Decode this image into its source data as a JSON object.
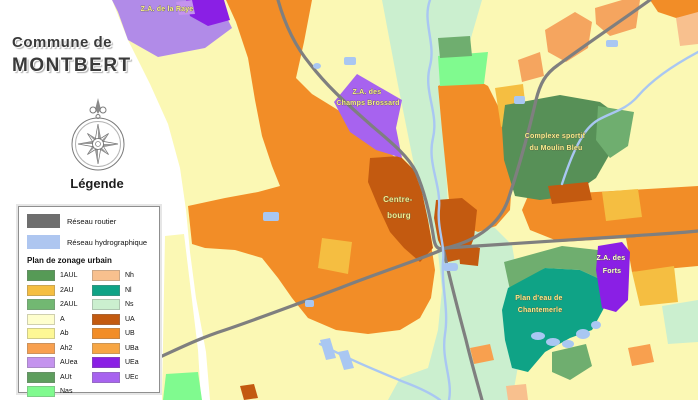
{
  "title": {
    "line1": "Commune de",
    "line2": "MONTBERT"
  },
  "legend": {
    "heading": "Légende",
    "network_items": [
      {
        "label": "Réseau routier",
        "color": "#6E6E6E"
      },
      {
        "label": "Réseau hydrographique",
        "color": "#AEC6F0"
      }
    ],
    "zonage_title": "Plan de zonage urbain",
    "zonage_left": [
      {
        "code": "1AUL",
        "color": "#569A56"
      },
      {
        "code": "2AU",
        "color": "#F5BE41"
      },
      {
        "code": "2AUL",
        "color": "#72B872"
      },
      {
        "code": "A",
        "color": "#FEFECD"
      },
      {
        "code": "Ab",
        "color": "#FDF795"
      },
      {
        "code": "Ah2",
        "color": "#F8A04F"
      },
      {
        "code": "AUea",
        "color": "#C493EE"
      },
      {
        "code": "AUt",
        "color": "#5E9E5E"
      },
      {
        "code": "Nas",
        "color": "#80FA8F"
      }
    ],
    "zonage_right": [
      {
        "code": "Nh",
        "color": "#F8C08E"
      },
      {
        "code": "Nl",
        "color": "#0FA386"
      },
      {
        "code": "Ns",
        "color": "#CBEFCF"
      },
      {
        "code": "UA",
        "color": "#C35A10"
      },
      {
        "code": "UB",
        "color": "#F28D27"
      },
      {
        "code": "UBa",
        "color": "#F7A644"
      },
      {
        "code": "UEa",
        "color": "#8A1FE5"
      },
      {
        "code": "UEc",
        "color": "#A763EF"
      }
    ]
  },
  "map": {
    "labels": [
      {
        "line1": "Z.A. de la Raye",
        "line2": ""
      },
      {
        "line1": "Z.A. des",
        "line2": "Champs Brossard"
      },
      {
        "line1": "Complexe sportif",
        "line2": "du Moulin Bleu"
      },
      {
        "line1": "Centre-",
        "line2": "bourg"
      },
      {
        "line1": "Plan d'eau de",
        "line2": "Chantemerle"
      },
      {
        "line1": "Z.A. des",
        "line2": "Forts"
      }
    ],
    "colors": {
      "road": "#7F7F7F",
      "water": "#A9C7F2",
      "base_agricultural": "#FBF8B4",
      "urban_center": "#C35A10",
      "urban": "#F28D27",
      "natural_corridor": "#CBEFCF",
      "leisure_teal": "#0FA386",
      "activity_purple": "#8A1FE5"
    }
  }
}
